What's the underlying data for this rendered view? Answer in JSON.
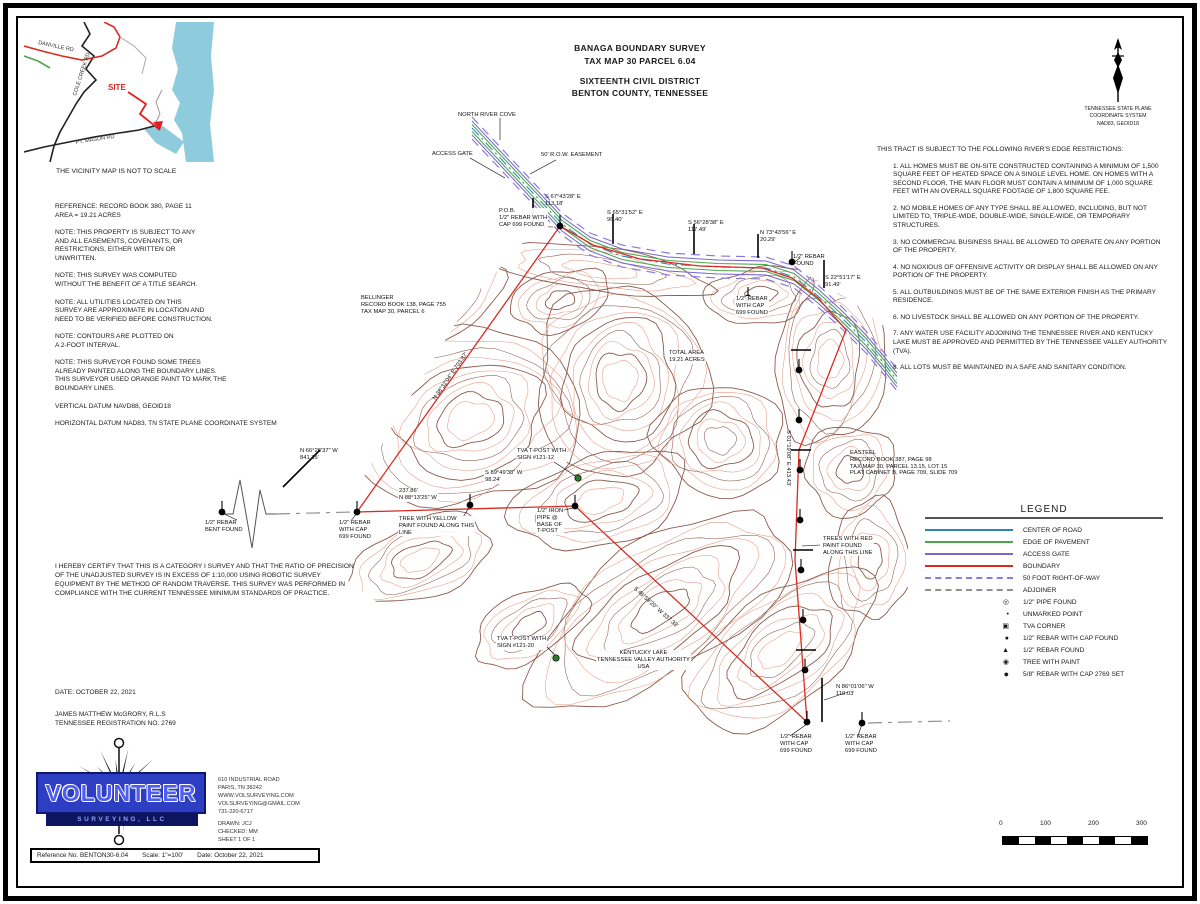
{
  "colors": {
    "boundary": "#d92b21",
    "road_center": "#2e86b0",
    "pavement": "#4ea64e",
    "access": "#7668cc",
    "row": "#8a7ae0",
    "adjoiner": "#909090",
    "contour_dark": "#8d5a4c",
    "contour_light": "#e59a82",
    "water": "#8ecbdc",
    "logo_blue": "#2e3ec2"
  },
  "header": {
    "title_line1": "BANAGA BOUNDARY SURVEY",
    "title_line2": "TAX MAP 30 PARCEL 6.04",
    "title_line3": "SIXTEENTH CIVIL DISTRICT",
    "title_line4": "BENTON COUNTY, TENNESSEE"
  },
  "vicinity": {
    "roads": [
      "DANVILLE RD",
      "COLE CREEK RD",
      "PT. MASON RD"
    ],
    "site_label": "SITE",
    "caption": "THE VICINITY MAP IS NOT TO SCALE"
  },
  "north_arrow": {
    "caption": "TENNESSEE STATE PLANE\nCOORDINATE SYSTEM\nNAD83, GEOID18"
  },
  "notes": [
    "REFERENCE: RECORD BOOK 380, PAGE 11\nAREA = 19.21 ACRES",
    "NOTE: THIS PROPERTY IS SUBJECT TO ANY\nAND ALL EASEMENTS, COVENANTS, OR\nRESTRICTIONS, EITHER WRITTEN OR\nUNWRITTEN.",
    "NOTE: THIS SURVEY WAS COMPUTED\nWITHOUT THE BENEFIT OF A TITLE SEARCH.",
    "NOTE: ALL UTILITIES LOCATED ON THIS\nSURVEY ARE APPROXIMATE IN LOCATION AND\nNEED TO BE VERIFIED BEFORE CONSTRUCTION.",
    "NOTE: CONTOURS ARE PLOTTED ON\nA 2-FOOT INTERVAL.",
    "NOTE: THIS SURVEYOR FOUND SOME TREES\nALREADY PAINTED ALONG THE BOUNDARY LINES.\nTHIS SURVEYOR USED ORANGE PAINT TO MARK THE\nBOUNDARY LINES.",
    "VERTICAL DATUM NAVD88, GEOID18",
    "HORIZONTAL DATUM NAD83, TN STATE PLANE COORDINATE SYSTEM"
  ],
  "restrictions": {
    "header": "THIS TRACT IS SUBJECT TO THE FOLLOWING RIVER'S EDGE RESTRICTIONS:",
    "items": [
      "1. ALL HOMES MUST BE ON-SITE CONSTRUCTED CONTAINING A MINIMUM OF 1,500 SQUARE FEET OF HEATED SPACE ON A SINGLE LEVEL HOME. ON HOMES WITH A SECOND FLOOR, THE MAIN FLOOR MUST CONTAIN A MINIMUM OF 1,000 SQUARE FEET WITH AN OVERALL SQUARE FOOTAGE OF 1,800 SQUARE FEE.",
      "2. NO MOBILE HOMES OF ANY TYPE SHALL BE ALLOWED, INCLUDING, BUT NOT LIMITED TO, TRIPLE-WIDE, DOUBLE-WIDE, SINGLE-WIDE, OR TEMPORARY STRUCTURES.",
      "3. NO COMMERCIAL BUSINESS SHALL BE ALLOWED TO OPERATE ON ANY PORTION OF THE PROPERTY.",
      "4. NO NOXIOUS OF OFFENSIVE ACTIVITY OR DISPLAY SHALL BE ALLOWED ON ANY PORTION OF THE PROPERTY.",
      "5. ALL OUTBUILDINGS MUST BE OF THE SAME EXTERIOR FINISH AS THE PRIMARY RESIDENCE.",
      "6. NO LIVESTOCK SHALL BE ALLOWED ON ANY PORTION OF THE PROPERTY.",
      "7. ANY WATER USE FACILITY ADJOINING THE TENNESSEE RIVER AND KENTUCKY LAKE MUST BE APPROVED AND PERMITTED BY THE TENNESSEE VALLEY AUTHORITY (TVA).",
      "8. ALL LOTS MUST BE MAINTAINED IN A SAFE AND SANITARY CONDITION."
    ]
  },
  "certification": "I HEREBY CERTIFY THAT THIS IS A CATEGORY I SURVEY AND THAT THE RATIO OF PRECISION OF THE UNADJUSTED SURVEY IS IN EXCESS OF 1:10,000 USING ROBOTIC SURVEY EQUIPMENT BY THE METHOD OF RANDOM TRAVERSE.  THIS SURVEY WAS PERFORMED IN COMPLIANCE WITH THE CURRENT TENNESSEE MINIMUM STANDARDS OF PRACTICE.",
  "date_line": "DATE: OCTOBER 22, 2021",
  "surveyor_line1": "JAMES MATTHEW McGRORY, R.L.S",
  "surveyor_line2": "TENNESSEE REGISTRATION NO. 2769",
  "legend": {
    "title": "LEGEND",
    "line_items": [
      {
        "label": "CENTER OF ROAD"
      },
      {
        "label": "EDGE OF PAVEMENT"
      },
      {
        "label": "ACCESS GATE"
      },
      {
        "label": "BOUNDARY"
      },
      {
        "label": "50 FOOT RIGHT-OF-WAY"
      },
      {
        "label": "ADJOINER"
      }
    ],
    "point_items": [
      {
        "symbol": "◎",
        "label": "1/2\" PIPE FOUND"
      },
      {
        "symbol": "•",
        "label": "UNMARKED POINT"
      },
      {
        "symbol": "▣",
        "label": "TVA CORNER"
      },
      {
        "symbol": "●",
        "label": "1/2\" REBAR WITH CAP FOUND"
      },
      {
        "symbol": "▲",
        "label": "1/2\" REBAR FOUND"
      },
      {
        "symbol": "◉",
        "label": "TREE WITH PAINT"
      },
      {
        "symbol": "●",
        "label": "5/8\" REBAR WITH CAP 2769 SET"
      }
    ]
  },
  "map_labels": {
    "road_name": "NORTH RIVER COVE",
    "access_gate": "ACCESS GATE",
    "row_easement": "50' R.O.W. EASEMENT",
    "pob": "P.O.B.\n1/2\" REBAR WITH\nCAP 699 FOUND",
    "bearing1": "S 67°43'28\" E\n113.18'",
    "bearing2": "S 65°31'52\" E\n96.40'",
    "bearing3": "S 56°28'38\" E\n117.49'",
    "bearing4": "N 73°43'56\" E\n20.29'",
    "bearing5": "S 22°51'17\" E\n91.49'",
    "rebar_found_ne": "1/2\" REBAR\nFOUND",
    "rebar_cap_ne": "1/2\" REBAR\nWITH CAP\n699 FOUND",
    "bellinger": "BELLINGER\nRECORD BOOK 138, PAGE 755\nTAX MAP 30, PARCEL 6",
    "total_area": "TOTAL AREA\n19.21 ACRES",
    "easteel": "EASTEEL\nRECORD BOOK 387, PAGE 98\nTAX MAP 30, PARCEL 13.15, LOT 15\nPLAT CABINET B, PAGE 709, SLIDE 709",
    "bearing_w": "N 66°28'37\" W\n841.35'",
    "rebar_bent": "1/2\" REBAR\nBENT FOUND",
    "rebar_cap_w": "1/2\" REBAR\nWITH CAP\n699 FOUND",
    "tpost1": "TVA T-POST WITH\nSIGN #121-12",
    "bearing_sw": "S 89°49'38\" W\n98.24'",
    "iron_pipe": "1/2\" IRON\nPIPE @\nBASE OF\nT-POST",
    "tree_yellow": "TREE WITH YELLOW\nPAINT FOUND ALONG THIS\nLINE",
    "bearing_mid": "237.86'\nN 88°13'25\" W",
    "trees_red": "TREES WITH RED\nPAINT FOUND\nALONG THIS LINE",
    "tpost2": "TVA T-POST WITH\nSIGN #121-20",
    "lake": "KENTUCKY LAKE\nTENNESSEE VALLEY AUTHORITY\nUSA",
    "bearing_s": "N 86°01'06\" W\n110.03'",
    "rebar_s1": "1/2\" REBAR\nWITH CAP\n699 FOUND",
    "rebar_s2": "1/2\" REBAR\nWITH CAP\n699 FOUND",
    "diag_bearing": "N 38°32'04\" E  703.87'",
    "east_bearing": "S 01°19'08\" E  413.43'",
    "sw_diag_bearing": "S 46°59'20\" W  337.33'"
  },
  "logo": {
    "name": "VOLUNTEER",
    "subname": "SURVEYING, LLC",
    "address": [
      "610 INDUSTRIAL ROAD",
      "PARIS, TN 38242",
      "WWW.VOLSURVEYING.COM",
      "VOLSURVEYING@GMAIL.COM",
      "731-220-6717"
    ],
    "drawn": "DRAWN: JCJ",
    "checked": "CHECKED: MM",
    "sheet": "SHEET 1 OF 1"
  },
  "footer": {
    "reference": "Reference No. BENTON30-6.04",
    "scale": "Scale: 1\"=100'",
    "date": "Date: October 22, 2021"
  },
  "scale_bar": {
    "ticks": [
      "0",
      "100",
      "200",
      "300"
    ]
  }
}
